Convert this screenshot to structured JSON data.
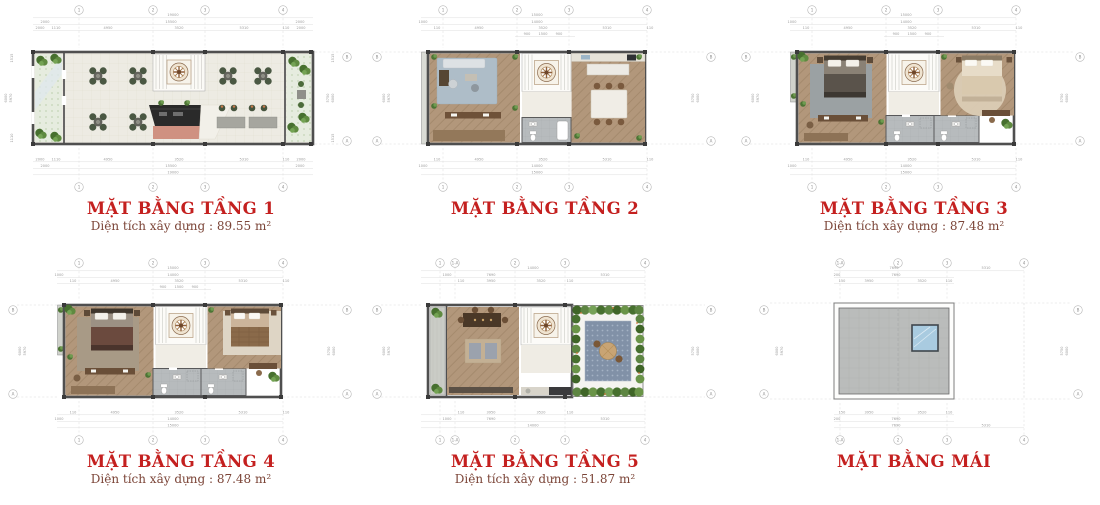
{
  "sheet": {
    "bg": "#ffffff"
  },
  "palette": {
    "title_red": "#c4201f",
    "subtitle_brown": "#7b4437",
    "wall": "#4f4f4f",
    "dim_text": "#9a9a9a",
    "wood_floor": "#b2977b",
    "tile_floor": "#edebe3",
    "garden_green": "#5d8542",
    "bath_gray": "#b6babc",
    "terrace_tile": "#8191a7",
    "roof_gray": "#babcbb",
    "skylight_blue": "#a9cbe0",
    "bar_dark": "#2a2a2a",
    "bar_base_pink": "#cf9181"
  },
  "grid": {
    "a": "A",
    "b": "B"
  },
  "plans": [
    {
      "id": "tang-1",
      "title": "MẶT BẰNG TẦNG 1",
      "subtitle": "Diện tích xây dựng : 89.55 m²",
      "bubbles": [
        "1",
        "2",
        "3",
        "4"
      ],
      "dims": {
        "total": "19000",
        "inner": "15500",
        "edge": "2000",
        "segs": [
          "2000",
          "1110",
          "4950",
          "3520",
          "5310",
          "110",
          "2000"
        ],
        "left": [
          "1515",
          "6000",
          "5970",
          "1110"
        ],
        "right": [
          "1515",
          "5750",
          "6000",
          "1515"
        ]
      }
    },
    {
      "id": "tang-2",
      "title": "MẶT BẰNG TẦNG 2",
      "subtitle": "",
      "bubbles": [
        "1",
        "2",
        "3",
        "4"
      ],
      "dims": {
        "total": "15000",
        "inner": "14000",
        "edge": "1000",
        "segs": [
          "110",
          "4950",
          "3520",
          "5310",
          "110"
        ],
        "stair": [
          "900",
          "1500",
          "900"
        ],
        "left": [
          "6000",
          "5970"
        ],
        "right": [
          "5750",
          "6000"
        ]
      }
    },
    {
      "id": "tang-3",
      "title": "MẶT BẰNG TẦNG 3",
      "subtitle": "Diện tích xây dựng : 87.48 m²",
      "bubbles": [
        "1",
        "2",
        "3",
        "4"
      ],
      "dims": {
        "total": "15000",
        "inner": "14000",
        "edge": "1000",
        "segs": [
          "110",
          "4950",
          "3520",
          "5310",
          "110"
        ],
        "stair": [
          "900",
          "1500",
          "900"
        ],
        "left": [
          "6000",
          "5970"
        ],
        "right": [
          "5750",
          "6000"
        ]
      }
    },
    {
      "id": "tang-4",
      "title": "MẶT BẰNG TẦNG 4",
      "subtitle": "Diện tích xây dựng : 87.48 m²",
      "bubbles": [
        "1",
        "2",
        "3",
        "4"
      ],
      "dims": {
        "total": "15000",
        "inner": "14000",
        "edge": "1000",
        "segs": [
          "110",
          "4950",
          "3520",
          "5310",
          "110"
        ],
        "stair": [
          "900",
          "1500",
          "900"
        ],
        "left": [
          "6000",
          "5970"
        ],
        "right": [
          "5750",
          "6000"
        ]
      }
    },
    {
      "id": "tang-5",
      "title": "MẶT BẰNG TẦNG 5",
      "subtitle": "Diện tích xây dựng : 51.87 m²",
      "bubbles": [
        "1",
        "1-A",
        "2",
        "3",
        "4"
      ],
      "dims": {
        "total": "14000",
        "r2": [
          "1000",
          "7690",
          "5310"
        ],
        "segs": [
          "110",
          "3950",
          "3520",
          "110"
        ],
        "left": [
          "6000",
          "5970"
        ],
        "right": [
          "5750",
          "6000"
        ]
      }
    },
    {
      "id": "mai",
      "title": "MẶT BẰNG MÁI",
      "subtitle": "",
      "bubbles": [
        "1-A",
        "2",
        "3",
        "4"
      ],
      "dims": {
        "r1a": "7690",
        "r1b": "5310",
        "r2a": "200",
        "r2b": "7690",
        "segs": [
          "150",
          "3950",
          "3520",
          "110"
        ],
        "left": [
          "6000",
          "5970"
        ],
        "right": [
          "5750",
          "6000"
        ]
      }
    }
  ]
}
